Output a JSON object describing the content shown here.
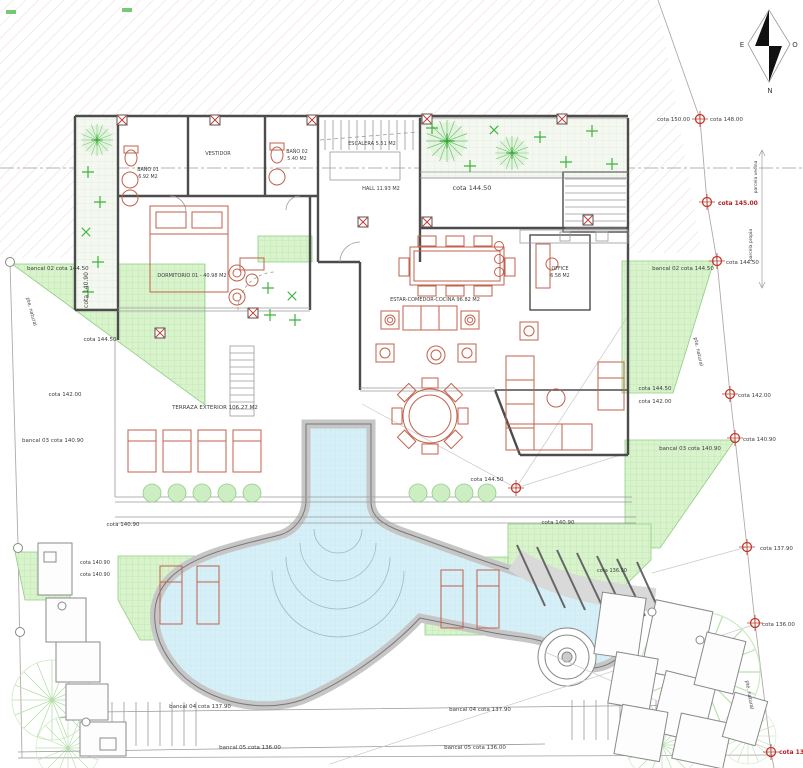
{
  "drawing": {
    "kind": "architectural floor plan – villa upper level with pool terraces"
  },
  "t": {
    "bano01_name": "BAÑO 01",
    "bano01_area": "6.92 M2",
    "bano02_name": "BAÑO 02",
    "bano02_area": "5.40 M2",
    "vestidor": "VESTIDOR",
    "escalera": "ESCALERA 5.51 M2",
    "hall": "HALL 11.93 M2",
    "dormitorio": "DORMITORIO 01 - 40.98 M2",
    "estar": "ESTAR-COMEDOR-COCINA 96.82 M2",
    "office_name": "OFFICE",
    "office_area": "6.58 M2",
    "terraza": "TERRAZA EXTERIOR 106.27 M2",
    "cota_150": "cota 150.00",
    "cota_148": "cota 148.00",
    "cota_145": "cota 145.00",
    "cota_14450": "cota 144.50",
    "cota_14200": "cota 142.00",
    "cota_14090": "cota 140.90",
    "cota_13790": "cota 137.90",
    "cota_13690": "cota 136.90",
    "cota_13600": "cota 136.00",
    "cota_13390": "cota 133.90",
    "bancal_02": "bancal 02 cota 144.50",
    "bancal_03": "bancal 03 cota 140.90",
    "bancal_04": "bancal 04 cota 137.90",
    "bancal_05": "bancal 05 cota 136.00",
    "pte_natural": "pte. natural",
    "boundary_upper": "parcela vecina",
    "boundary_lower": "parcela propia"
  },
  "compass": {
    "east": "E",
    "west": "O",
    "north": "N"
  },
  "colors": {
    "hatch": "#eadcdc",
    "grass": "#d9f3cd",
    "grass_grid": "#bce5ae",
    "water": "#d7f0f7",
    "water_grid": "#c0e4ef",
    "wall": "#4c4c4c",
    "thin_line": "#9a9a9a",
    "furniture_red": "#c2604c",
    "marker_red": "#c0392b",
    "level_red": "#b21f24",
    "plant_green": "#3db33d",
    "tree_green": "#b5e0aa",
    "deck_gray": "#c6c6c6"
  }
}
